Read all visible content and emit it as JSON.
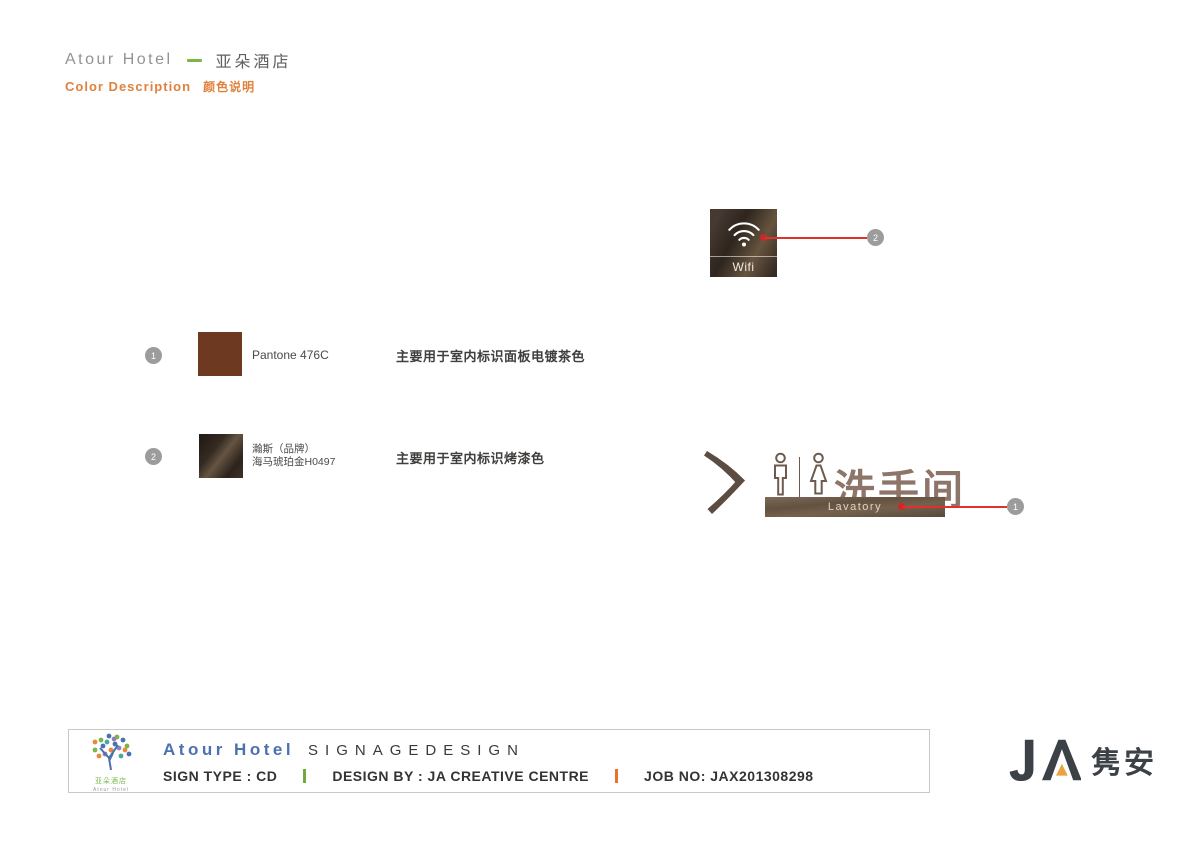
{
  "header": {
    "brand_en": "Atour Hotel",
    "brand_cn": "亚朵酒店",
    "section_en": "Color Description",
    "section_cn": "颜色说明"
  },
  "wifi_sign": {
    "label": "Wifi",
    "callout_num": "2"
  },
  "swatches": [
    {
      "num": "1",
      "name": "Pantone 476C",
      "desc": "主要用于室内标识面板电镀茶色",
      "color": "#6d3a21"
    },
    {
      "num": "2",
      "name_line1": "瀚斯（品牌）",
      "name_line2": "海马琥珀金H0497",
      "desc": "主要用于室内标识烤漆色",
      "color": "#352b23"
    }
  ],
  "lavatory_sign": {
    "label_cn": "洗手间",
    "label_en": "Lavatory",
    "callout_num": "1"
  },
  "footer": {
    "logo_cn": "亚朵酒店",
    "logo_en": "Atour Hotel",
    "brand": "Atour Hotel",
    "title": "SIGNAGEDESIGN",
    "sign_type": "SIGN TYPE : CD",
    "design_by": "DESIGN BY : JA CREATIVE CENTRE",
    "job_no": "JOB NO: JAX201308298"
  },
  "ja_logo": {
    "text_cn": "隽安"
  },
  "palette": {
    "accent_orange": "#e0823f",
    "accent_green": "#7ab648",
    "callout_red": "#e03030",
    "badge_gray": "#9c9c9c",
    "footer_blue": "#4a72b0",
    "ja_orange": "#eba23f",
    "pantone_476c": "#6d3a21",
    "sign_panel_brown": "#63523f"
  }
}
